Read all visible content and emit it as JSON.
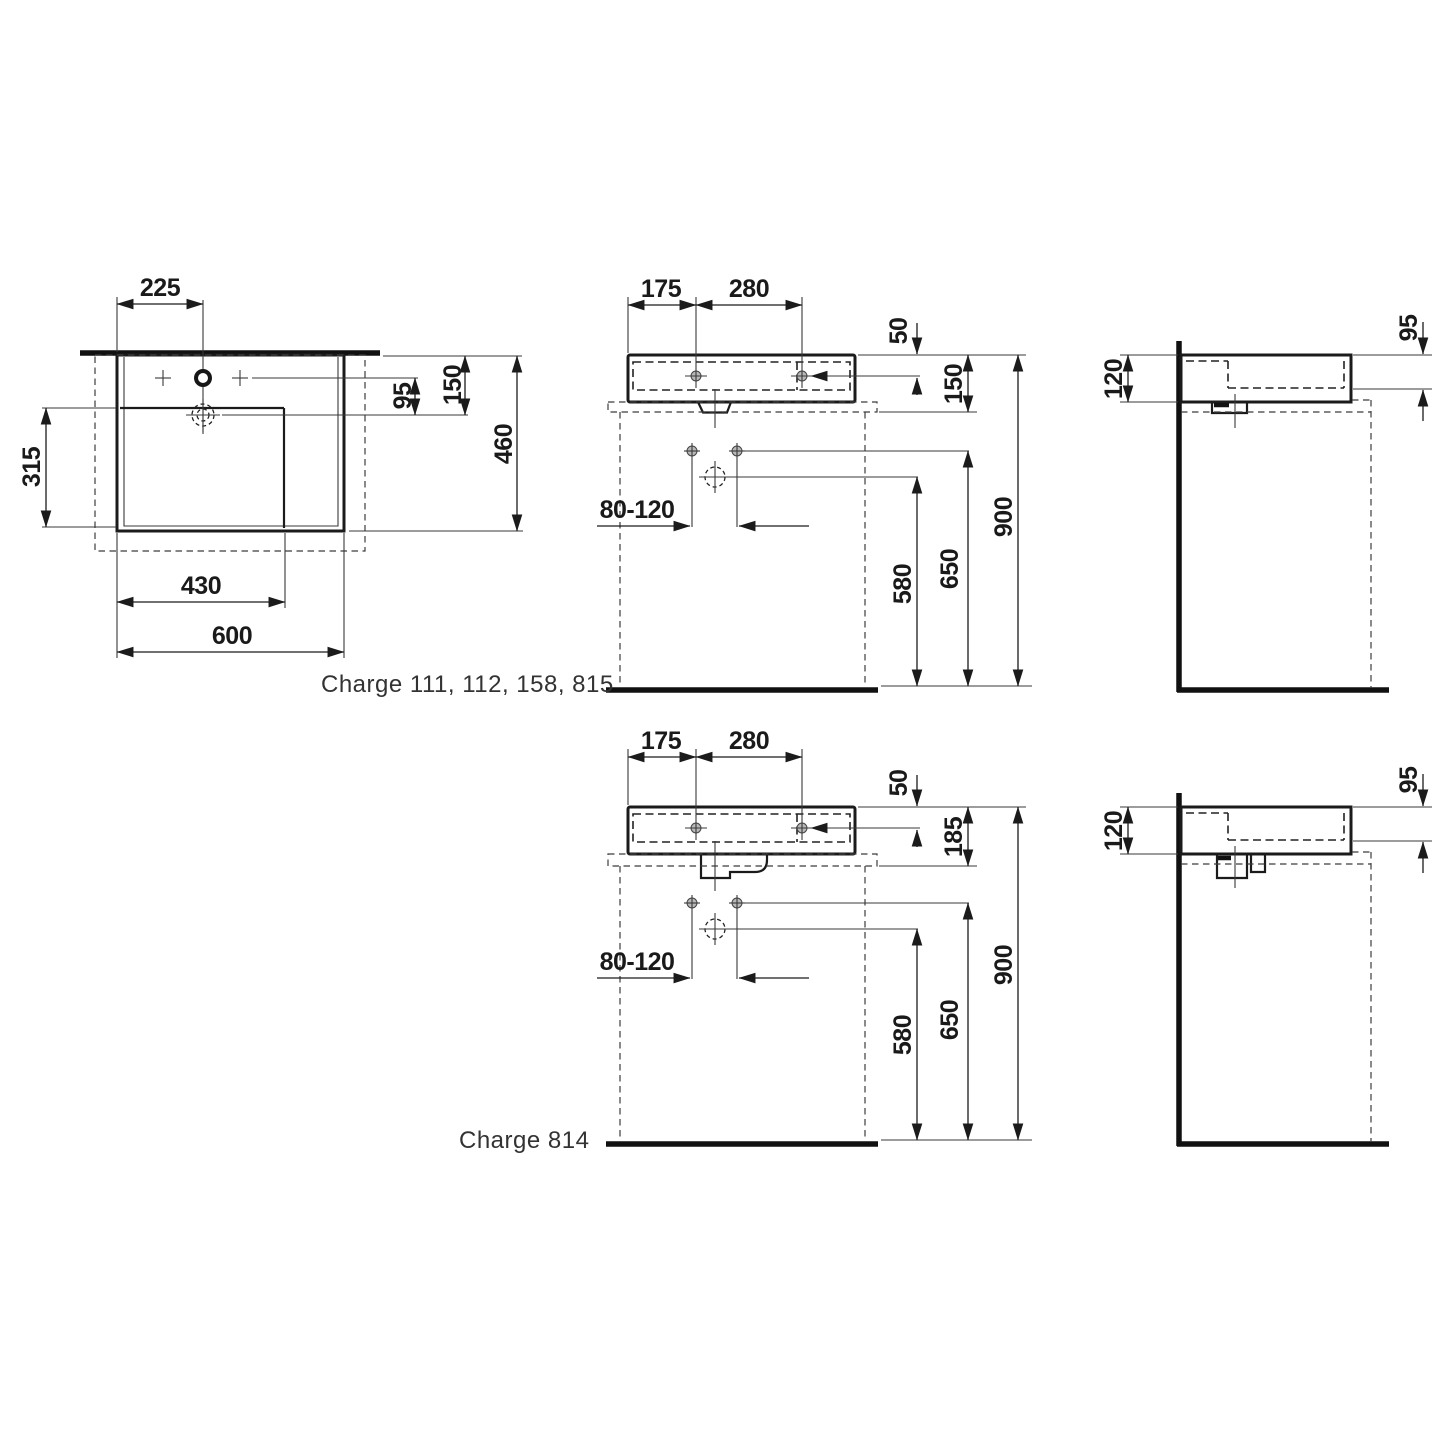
{
  "product_labels": {
    "top_group": "Charge 111, 112, 158, 815",
    "bottom_group": "Charge 814"
  },
  "views": {
    "plan": {
      "dims": {
        "tap_hole_offset": "225",
        "tap_to_drain": "95",
        "rim_to_drain": "150",
        "overall_depth": "460",
        "basin_depth": "315",
        "basin_width": "430",
        "overall_width": "600"
      }
    },
    "front_wall_hung": {
      "dims": {
        "tap_from_left": "175",
        "tap_hole_spacing": "280",
        "tap_below_rim": "50",
        "body_height": "150",
        "fixing_hole_span": "80-120",
        "drain_height": "580",
        "fixing_height": "650",
        "rim_height": "900"
      }
    },
    "side_wall_hung": {
      "dims": {
        "body_height": "120",
        "basin_inner_depth": "95"
      }
    },
    "front_countertop": {
      "dims": {
        "tap_from_left": "175",
        "tap_hole_spacing": "280",
        "tap_below_rim": "50",
        "body_height": "185",
        "fixing_hole_span": "80-120",
        "drain_height": "580",
        "fixing_height": "650",
        "rim_height": "900"
      }
    },
    "side_countertop": {
      "dims": {
        "body_height": "120",
        "basin_inner_depth": "95"
      }
    }
  }
}
